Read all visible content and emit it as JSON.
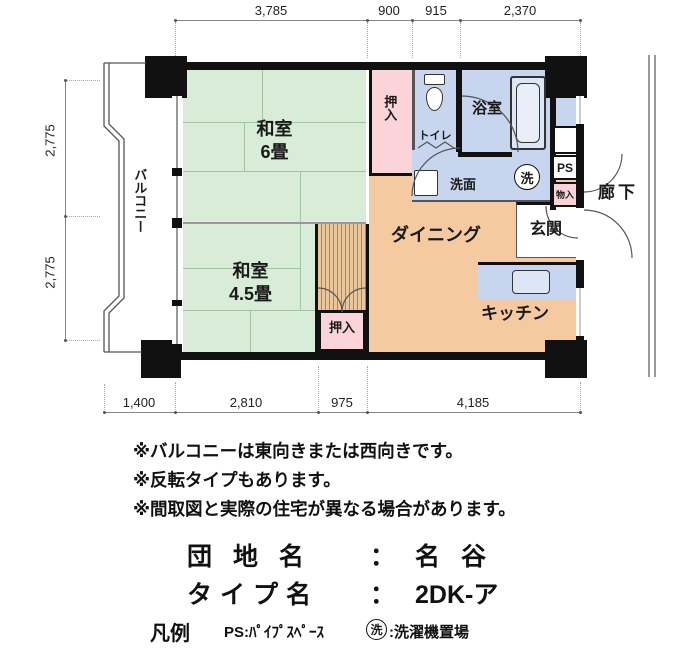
{
  "plan": {
    "dims_top": [
      "3,785",
      "900",
      "915",
      "2,370"
    ],
    "dims_left": [
      "2,775",
      "2,775"
    ],
    "dims_bottom": [
      "1,400",
      "2,810",
      "975",
      "4,185"
    ],
    "rooms": {
      "washitsu6": {
        "name": "和室",
        "size": "6畳"
      },
      "washitsu45": {
        "name": "和室",
        "size": "4.5畳"
      },
      "dining": "ダイニング",
      "kitchen": "キッチン",
      "entrance": "玄関",
      "balcony": "バルコニー",
      "corridor": "廊下",
      "bath": "浴室",
      "toilet": "トイレ",
      "washstand": "洗面",
      "closet_upper": "押入",
      "closet_lower": "押入",
      "pipe_space": "PS",
      "storage": "物入",
      "laundry_mark": "洗"
    }
  },
  "notes": [
    "※バルコニーは東向きまたは西向きです。",
    "※反転タイプもあります。",
    "※間取図と実際の住宅が異なる場合があります。"
  ],
  "title": {
    "estate_label": "団 地 名",
    "separator": "：",
    "estate_value": "名 谷",
    "type_label": "タイプ名",
    "type_value": "2DK-ア"
  },
  "legend": {
    "heading": "凡例",
    "ps_text": "PS:ﾊﾟｲﾌﾟｽﾍﾟｰｽ",
    "laundry_symbol": "洗",
    "laundry_text": ":洗濯機置場"
  },
  "colors": {
    "tatami_green": "#d9ecd8",
    "wood_orange": "#f6caa0",
    "water_blue": "#c7d5ee",
    "closet_pink": "#fbd4da",
    "wall_black": "#111111"
  }
}
